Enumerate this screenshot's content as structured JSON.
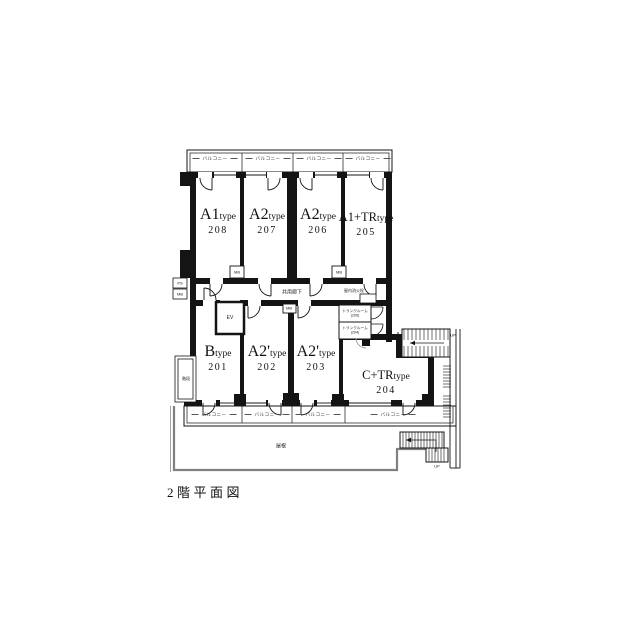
{
  "page_title": "2階平面図",
  "labels": {
    "balcony": "バルコニー",
    "corridor": "共用廊下",
    "elevator": "EV",
    "meter_box": "MB",
    "pipe_space": "PS",
    "fire_hydrant": "屋内消火栓",
    "stairs": "階段",
    "roof": "屋根",
    "up": "UP"
  },
  "trunk_rooms": [
    {
      "name": "トランクルーム",
      "unit_ref": "(205)"
    },
    {
      "name": "トランクルーム",
      "unit_ref": "(204)"
    }
  ],
  "units_upper": [
    {
      "type_main": "A1",
      "type_suffix": "type",
      "room_number": "208"
    },
    {
      "type_main": "A2",
      "type_suffix": "type",
      "room_number": "207"
    },
    {
      "type_main": "A2",
      "type_suffix": "type",
      "room_number": "206"
    },
    {
      "type_main": "A1+TR",
      "type_suffix": "type",
      "room_number": "205"
    }
  ],
  "units_lower": [
    {
      "type_main": "B",
      "type_suffix": "type",
      "room_number": "201"
    },
    {
      "type_main": "A2'",
      "type_suffix": "type",
      "room_number": "202"
    },
    {
      "type_main": "A2'",
      "type_suffix": "type",
      "room_number": "203"
    },
    {
      "type_main": "C+TR",
      "type_suffix": "type",
      "room_number": "204"
    }
  ],
  "colors": {
    "wall": "#141414",
    "roof_outline": "#808080",
    "door_gray": "#999999"
  }
}
